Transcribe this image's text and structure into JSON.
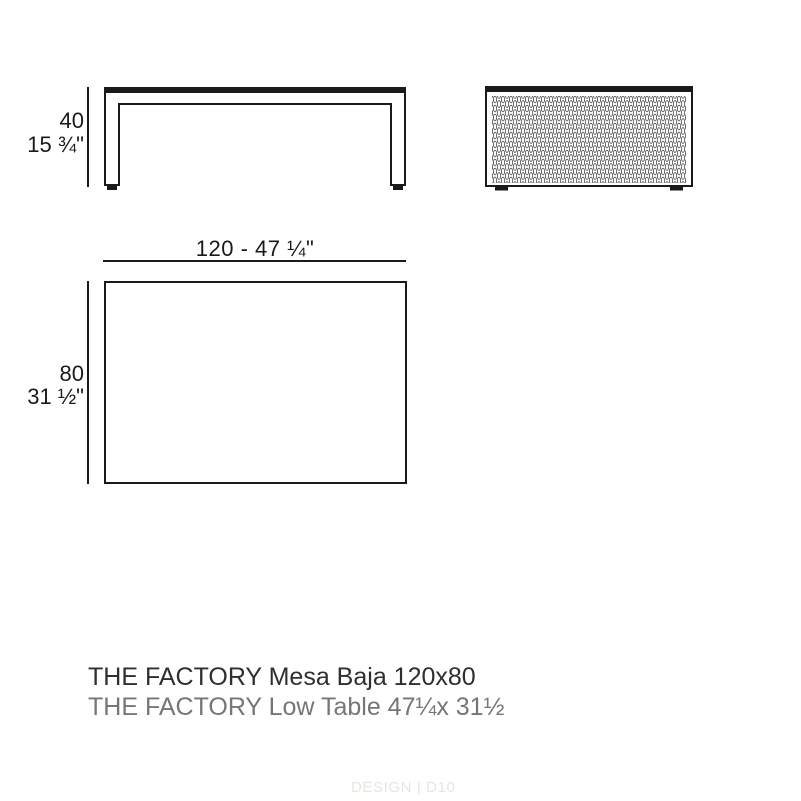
{
  "colors": {
    "bg": "#ffffff",
    "line": "#1a1a1a",
    "title1": "#2f2f2f",
    "title2": "#767676",
    "watermark": "#eae4de",
    "mesh": "#4a4a4a"
  },
  "front_view": {
    "description": "front elevation of low table with two legs",
    "height_cm": "40",
    "height_in": "15 ¾\""
  },
  "side_view": {
    "description": "side elevation filled with perforated diamond mesh pattern"
  },
  "plan_view": {
    "width_dim": "120 - 47 ¼\"",
    "depth_cm": "80",
    "depth_in": "31 ½\""
  },
  "titles": {
    "primary": "THE FACTORY Mesa Baja 120x80",
    "secondary": "THE FACTORY Low Table 47¼x 31½"
  },
  "watermark": {
    "text": "DESIGN | D10"
  }
}
